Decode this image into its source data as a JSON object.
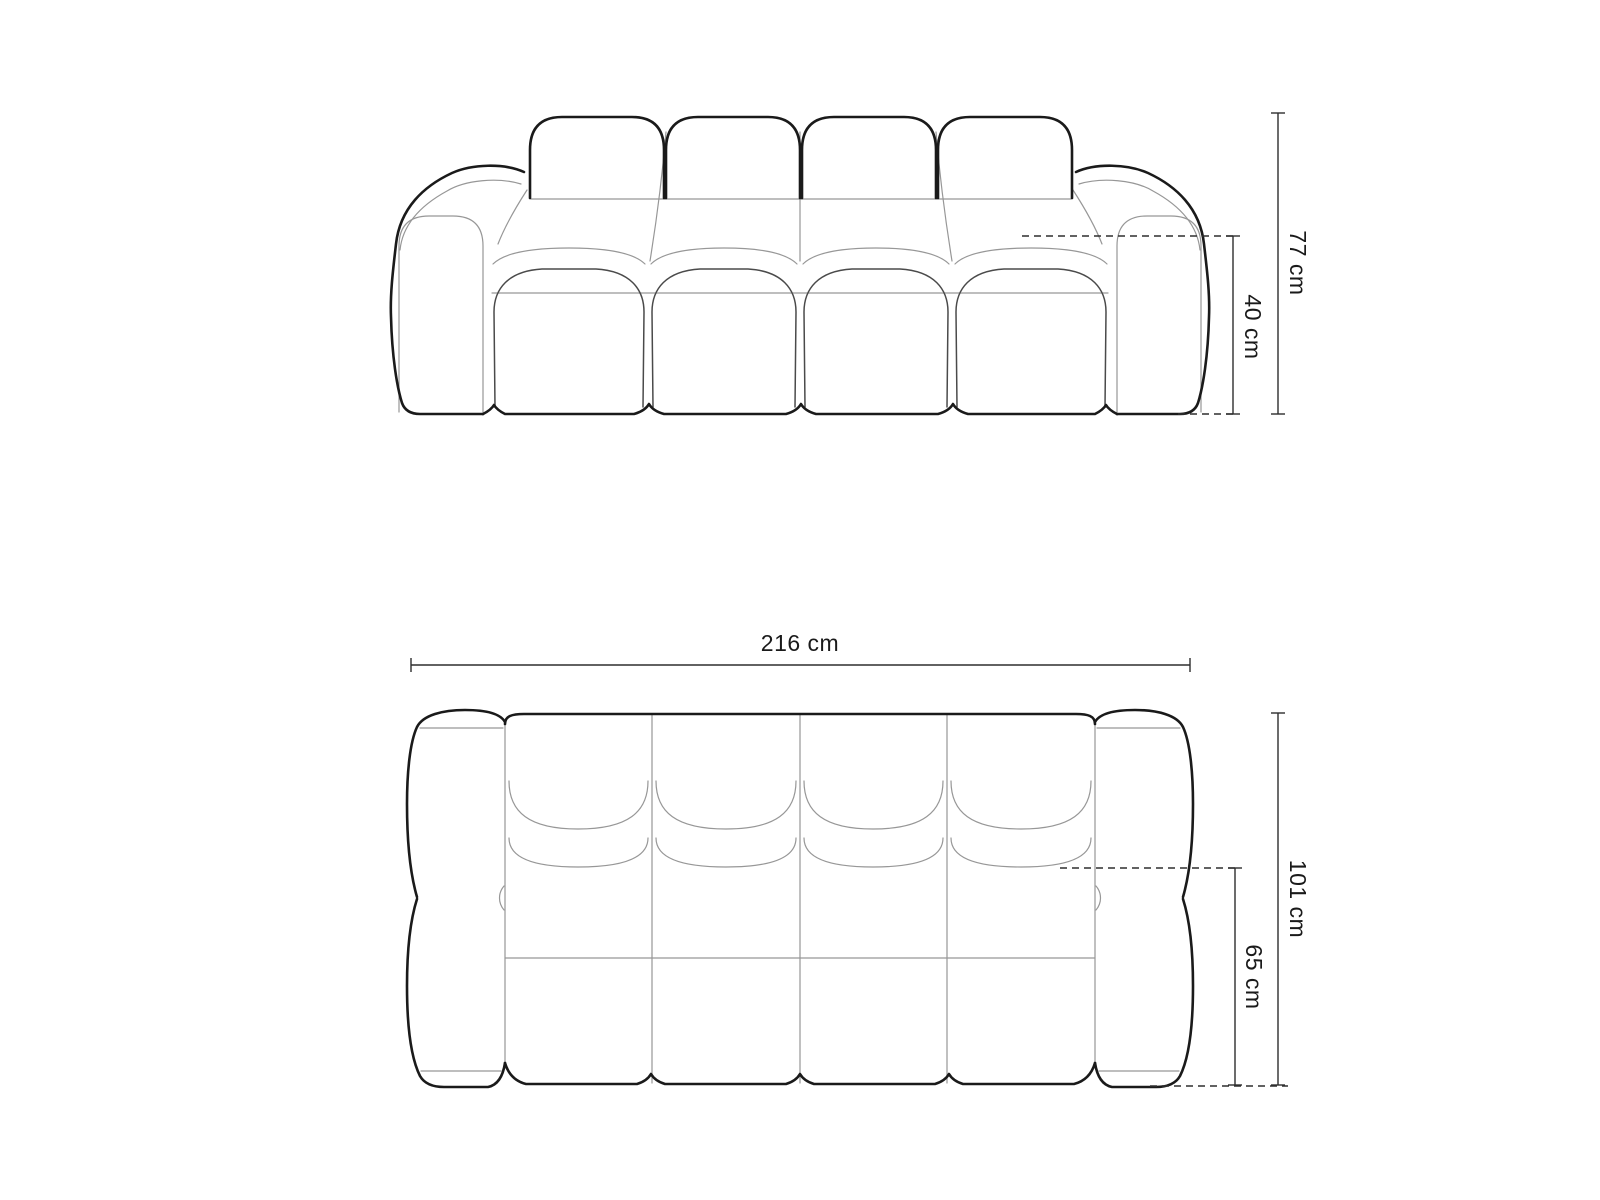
{
  "diagram": {
    "type": "furniture-dimension-drawing",
    "subject": "sofa",
    "colors": {
      "background": "#ffffff",
      "outline_ink": "#1a1a1a",
      "seam_gray": "#979797",
      "dimension_ink": "#2e2e2e"
    },
    "views": {
      "front": {
        "name": "front elevation",
        "back_cushions": 4,
        "seat_cushions": 4,
        "dimensions": {
          "overall_height": "77 cm",
          "seat_height": "40 cm"
        }
      },
      "top": {
        "name": "top plan",
        "back_cushions": 4,
        "seat_columns": 4,
        "dimensions": {
          "overall_width": "216 cm",
          "overall_depth": "101 cm",
          "seat_depth": "65 cm"
        }
      }
    }
  }
}
